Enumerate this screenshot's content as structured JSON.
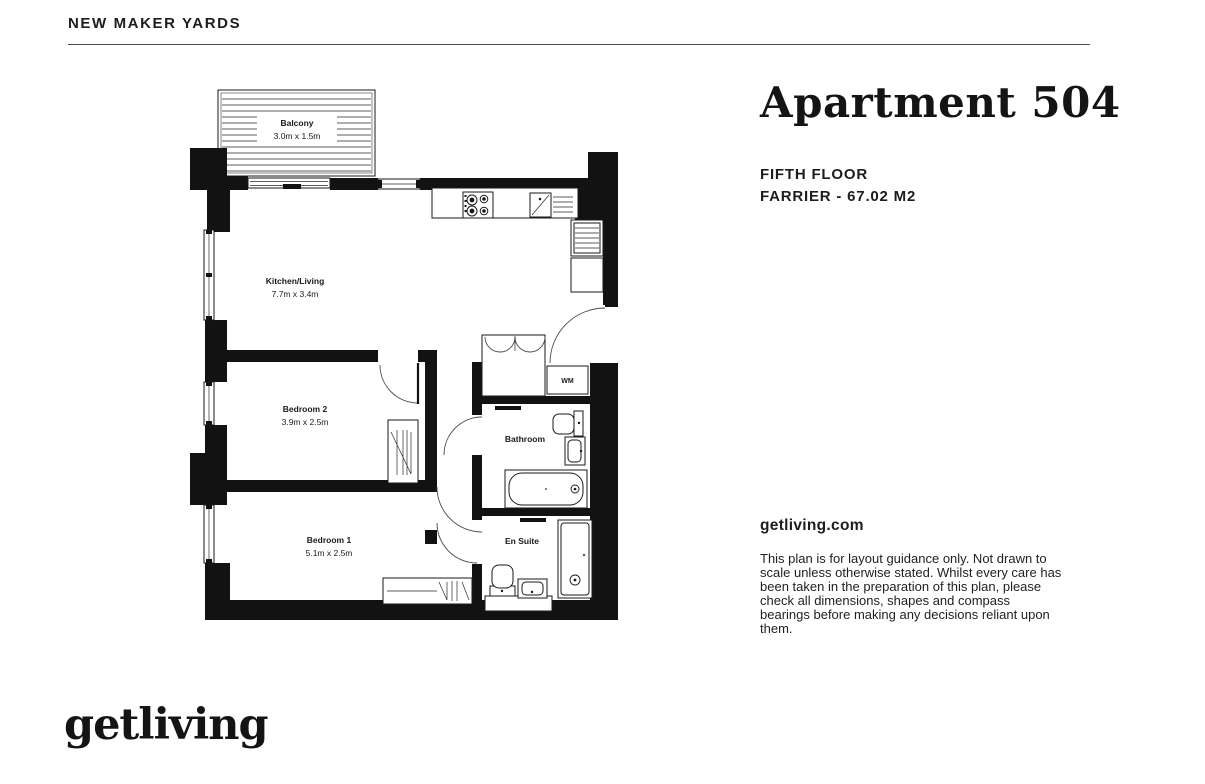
{
  "header": {
    "site_name": "NEW MAKER YARDS"
  },
  "listing": {
    "title": "Apartment 504",
    "floor": "FIFTH FLOOR",
    "unit_area": "FARRIER - 67.02 M2",
    "website": "getliving.com",
    "disclaimer": "This plan is for layout guidance only. Not drawn to scale unless otherwise stated. Whilst every care has been taken in the preparation of this plan, please check all dimensions, shapes and compass bearings before making any decisions reliant upon them."
  },
  "floorplan": {
    "rooms": [
      {
        "name": "Balcony",
        "dimensions": "3.0m x 1.5m"
      },
      {
        "name": "Kitchen/Living",
        "dimensions": "7.7m x 3.4m"
      },
      {
        "name": "Bedroom 2",
        "dimensions": "3.9m x 2.5m"
      },
      {
        "name": "Bedroom 1",
        "dimensions": "5.1m x 2.5m"
      },
      {
        "name": "Bathroom",
        "dimensions": ""
      },
      {
        "name": "En Suite",
        "dimensions": ""
      }
    ],
    "appliances": {
      "washing_machine": "WM"
    }
  },
  "footer": {
    "logo": "getliving"
  },
  "colors": {
    "ink": "#1d1d1b",
    "wall": "#121212",
    "rule": "#4a4a4a",
    "background": "#ffffff"
  }
}
